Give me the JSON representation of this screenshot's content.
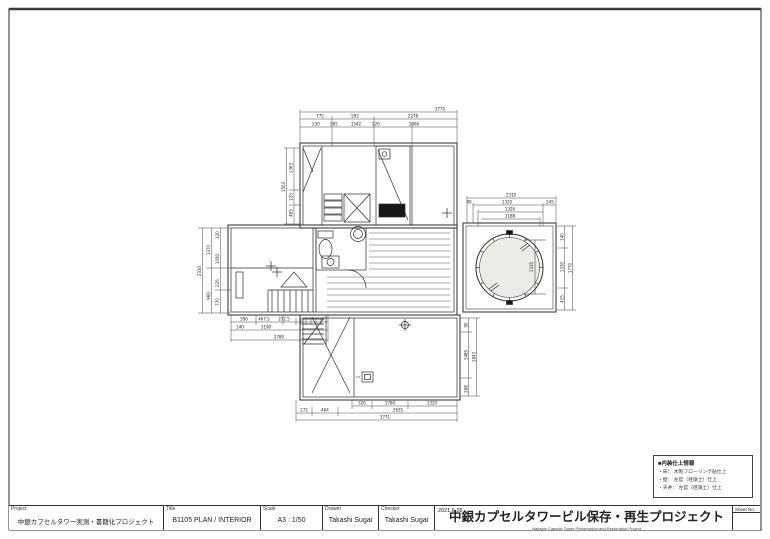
{
  "title_block": {
    "project_label": "Project",
    "project": "中銀カプセルタワー実測・書籍化プロジェクト",
    "title_label": "Title",
    "title": "B1105 PLAN / INTERIOR",
    "scale_label": "Scale",
    "scale": "A3 : 1/50",
    "drawer_label": "Drawer",
    "drawer": "Takashi Sugai",
    "checker_label": "Checker",
    "checker": "Takashi Sugai",
    "date": "2021.6.28",
    "org_title": "中銀カプセルタワービル保存・再生プロジェクト",
    "org_subtitle": "Nakagin Capsule Tower Preservation and Restoration Project",
    "sheet_label": "Sheet No."
  },
  "legend": {
    "heading": "■内装仕上情報",
    "items": [
      "・床： 木製フローリング貼仕上",
      "・壁： 左官（珪藻土）仕上",
      "・天井： 左官（珪藻土）仕上"
    ]
  },
  "dims": {
    "top_overall": "3775",
    "top1": [
      "775",
      "592",
      "2278"
    ],
    "top2": [
      "230",
      "505",
      "1542",
      "220",
      "2066"
    ],
    "left_top": [
      "1503",
      "1363",
      "120",
      "465"
    ],
    "left_mid": [
      "2330",
      "1370",
      "960",
      "120",
      "1050",
      "225",
      "770"
    ],
    "stair1": [
      "590",
      "467.5",
      "272.5"
    ],
    "stair2": [
      "140",
      "1190"
    ],
    "stair_overall": "2780",
    "bottom1": [
      "320",
      "1780",
      "1320"
    ],
    "bottom2": [
      "272",
      "464",
      "2635"
    ],
    "bottom_overall": "3771",
    "right_bottom": [
      "90",
      "1485",
      "268",
      "1843"
    ],
    "elev_top_overall": "2310",
    "elev_top2": [
      "1320",
      "245"
    ],
    "elev_top3": "1326",
    "elev_top4": "1188",
    "elev_small": "40",
    "elev_right": [
      "140",
      "1330",
      "415",
      "1770"
    ],
    "elev_inner": "1335"
  },
  "colors": {
    "line": "#2a2a2a",
    "dim_text": "#222222",
    "background": "#ffffff",
    "window_glass": "#ebebe8"
  }
}
